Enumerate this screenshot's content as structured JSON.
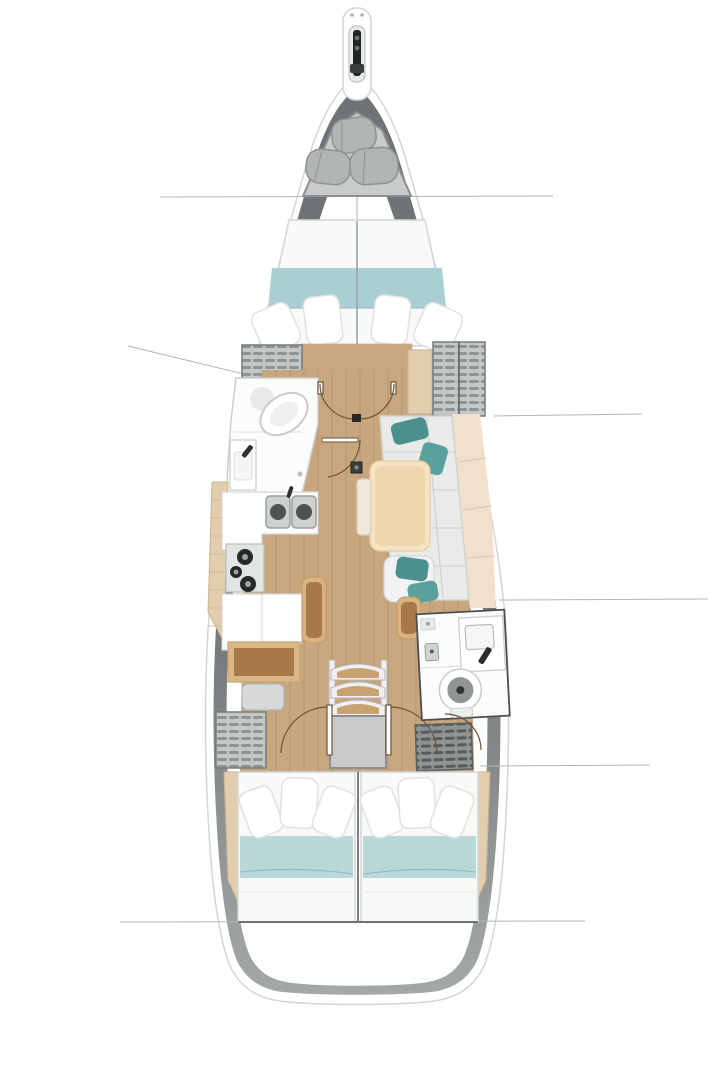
{
  "figure": {
    "kind": "sailboat-interior-deck-plan",
    "orientation": "bow-up",
    "visible_elements": [
      "bowsprit-anchor-roller",
      "sail-locker-with-sail-bags",
      "forward-cabin-double-berth",
      "forward-head-toilet-sink-shower",
      "hanging-lockers",
      "saloon-l-sofa",
      "saloon-table",
      "saloon-ottomans",
      "galley-double-sink",
      "galley-stove",
      "galley-cabinet",
      "chart-table",
      "chart-seat",
      "mast-step",
      "companionway-steps",
      "aft-head-toilet-sink",
      "aft-cabin-port-berth",
      "aft-cabin-starboard-berth",
      "cabin-door-swings",
      "hull-section-lines"
    ]
  },
  "colors": {
    "hull_rim": "#ffffff",
    "hull_rim_stroke": "#d3d6d6",
    "hull_band_top": "#6f7375",
    "hull_band_bottom": "#a4a8a8",
    "interior": "#fdfdfd",
    "section_line": "#b4b4b4",
    "platform": "#c8cacb",
    "platform_stroke": "#8b8f90",
    "sailbag": "#b2b5b5",
    "sailbag_stroke": "#8d9191",
    "anchor_dark": "#212424",
    "metal_mid": "#3a3d3d",
    "duvet": "#f8f9f9",
    "duvet_stroke": "#d2d6d6",
    "blanket_fwd": "#a9cfd3",
    "blanket_aft": "#b9d9d9",
    "blanket_seam": "#93b6b8",
    "pillow": "#ffffff",
    "pillow_stroke": "#dfe2e2",
    "floor_wood": "#c8a67e",
    "plank_line": "rgba(92,61,30,0.10)",
    "side_shelf": "#e2cdae",
    "side_shelf_stroke": "#cdb490",
    "fixture_white": "#fbfcfc",
    "fixture_stroke": "#c9cccc",
    "room_stroke": "#cbcfcf",
    "room_stroke_dark": "#4e4e4e",
    "steel": "#cdd1d1",
    "steel_stroke": "#9aa0a0",
    "sink_dark": "#4e5354",
    "burner": "#26292a",
    "burner_center": "#9ea4a4",
    "cabinet_white": "#fefefe",
    "cabinet_stroke": "#d5d5d5",
    "desk_rim": "#d9b788",
    "desk_top": "#a87948",
    "seat_gray": "#d7d9d9",
    "seat_stroke": "#b3b6b6",
    "locker_bg": "#c3c7c7",
    "locker_slat": "#8e9494",
    "locker_stroke": "#767b7b",
    "locker_dark_bg": "#8e9494",
    "locker_dark_slat": "#565c5c",
    "sofa": "#e9ebe8",
    "sofa_stroke": "#cfd4cf",
    "sofa_seam": "#c9cec9",
    "backrest": "#f2e0cd",
    "backrest_seam": "#dcc7b1",
    "teal_pillow_a": "#4a918e",
    "teal_pillow_b": "#5aa19d",
    "table_rim": "#f6e3c2",
    "table_top": "#efd6ae",
    "table_stroke": "#e8cda2",
    "bench": "#efe8da",
    "bench_stroke": "#d8d0bf",
    "ottoman_rim": "#d9b282",
    "ottoman_top": "#a87948",
    "steps_wood": "#c9a272",
    "steps_frame": "#f0f0f0",
    "steps_stroke": "#b5b5b5",
    "landing": "#c9cacb",
    "landing_stroke": "#8b8e8e",
    "door_line": "#6b533b",
    "mast": "#3c3e3e",
    "toilet_ring": "#8f9494",
    "toilet_dot": "#2f3434",
    "faucet": "#2e2e2e"
  }
}
